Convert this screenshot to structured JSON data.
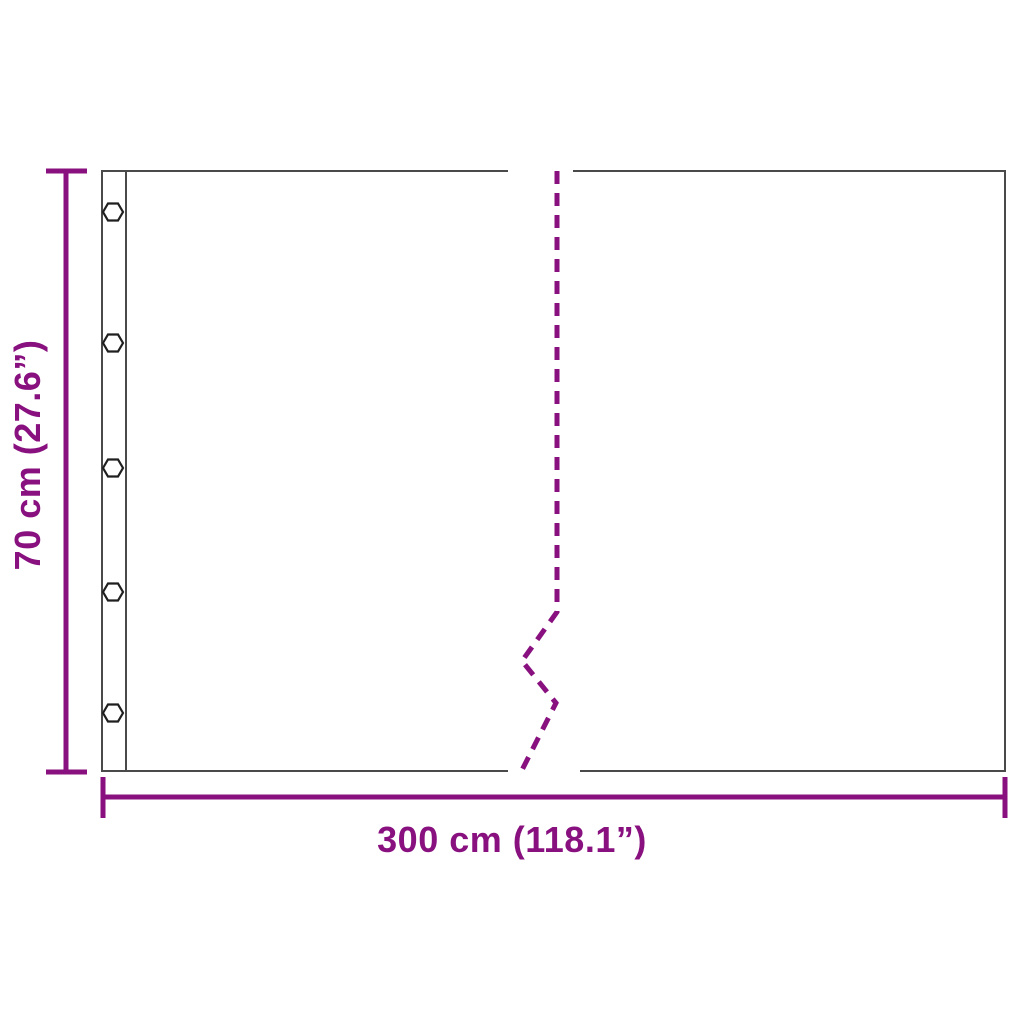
{
  "diagram": {
    "type": "product-dimension-diagram",
    "labels": {
      "width": "300 cm (118.1”)",
      "height": "70 cm (27.6”)"
    },
    "eyelets": {
      "count": 5,
      "shape": "hexagon"
    },
    "colors": {
      "dimension_purple": "#88107F",
      "panel_outline": "#4A4A4A",
      "eyelet_stroke": "#1F1F1F",
      "background": "#FFFFFF"
    }
  }
}
